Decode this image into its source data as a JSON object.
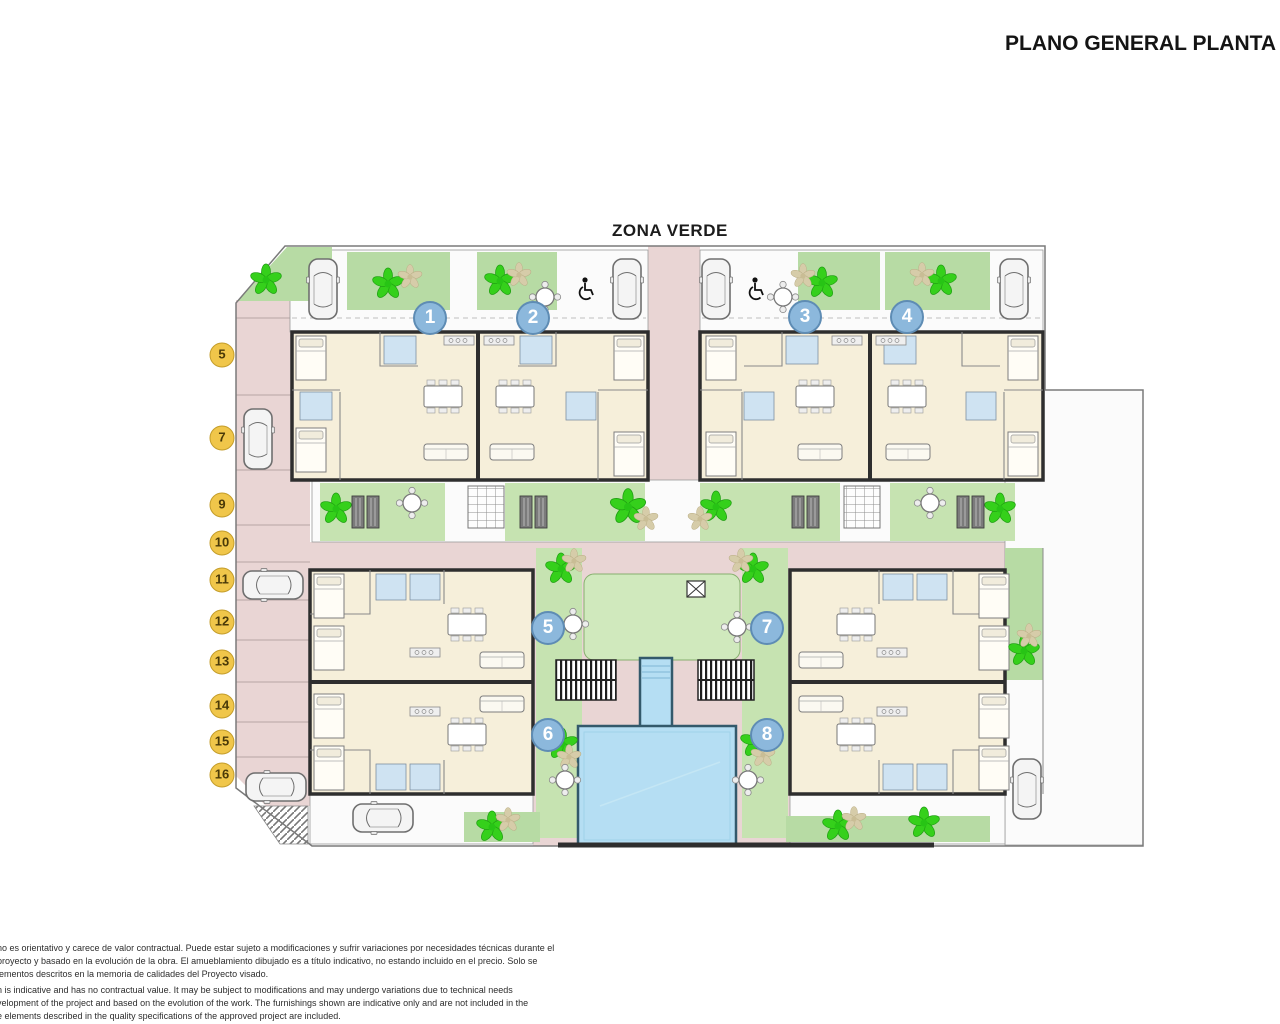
{
  "header": {
    "title": "PLANO GENERAL PLANTA B"
  },
  "plan": {
    "area_label": "ZONA VERDE",
    "units": [
      {
        "label": "1"
      },
      {
        "label": "2"
      },
      {
        "label": "3"
      },
      {
        "label": "4"
      },
      {
        "label": "5"
      },
      {
        "label": "6"
      },
      {
        "label": "7"
      },
      {
        "label": "8"
      }
    ],
    "parking_spaces": [
      {
        "label": "5"
      },
      {
        "label": "7"
      },
      {
        "label": "9"
      },
      {
        "label": "10"
      },
      {
        "label": "11"
      },
      {
        "label": "12"
      },
      {
        "label": "13"
      },
      {
        "label": "14"
      },
      {
        "label": "15"
      },
      {
        "label": "16"
      }
    ]
  },
  "legal": {
    "es_lines": [
      "no es orientativo y carece de valor contractual. Puede estar sujeto a modificaciones y sufrir variaciones por necesidades técnicas durante el",
      "proyecto y basado en la evolución de la obra. El amueblamiento dibujado es a título indicativo, no estando incluido en el precio. Solo se",
      "lementos descritos en la memoria de calidades del Proyecto visado."
    ],
    "en_lines": [
      "n is indicative and has no contractual value. It may be subject to modifications and may undergo variations due to technical needs",
      "velopment of the project and based on the evolution of the work. The furnishings shown are indicative only and are not included in the",
      "e elements described in the quality specifications of the approved project are included."
    ]
  },
  "colors": {
    "road_pink": "#e9d5d4",
    "garden_green": "#b7dba4",
    "mid_green": "#c6e3b1",
    "turf_green": "#d0e9bd",
    "pool_blue": "#b5def3",
    "bath_blue": "#cfe3f2",
    "cream": "#f6efda",
    "wall_dark": "#2e2e2e",
    "unit_blue": "#8cb8dc",
    "unit_blue_border": "#5e8cb4",
    "parking_yellow": "#f0c64a",
    "parking_border": "#c49d2a",
    "plant_green": "#35d01b",
    "plant_tan": "#d6cca9"
  },
  "icons": {
    "car": "car-icon",
    "plant": "plant-icon",
    "wheelchair": "wheelchair-icon",
    "round_table": "round-table-icon",
    "stairs": "stairs-icon",
    "skylight": "skylight-icon",
    "sun_lounger": "sun-lounger-icon",
    "pool": "pool"
  }
}
